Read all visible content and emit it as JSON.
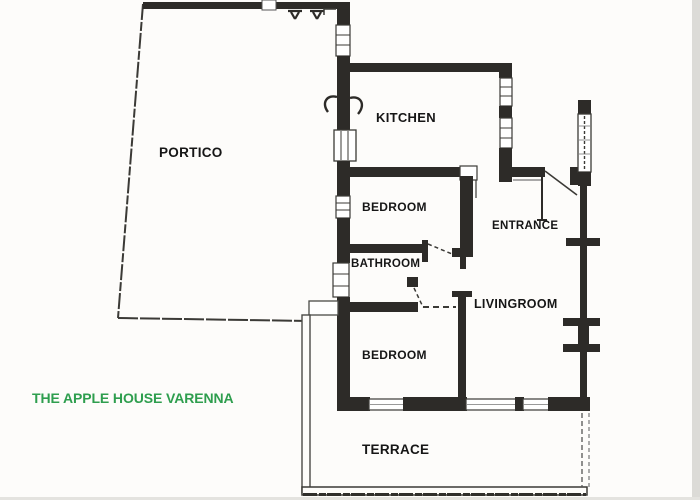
{
  "title": {
    "text": "THE APPLE HOUSE VARENNA",
    "color": "#2e9e4e"
  },
  "rooms": [
    {
      "name": "portico",
      "label": "PORTICO"
    },
    {
      "name": "kitchen",
      "label": "KITCHEN"
    },
    {
      "name": "bedroom-1",
      "label": "BEDROOM"
    },
    {
      "name": "entrance",
      "label": "ENTRANCE"
    },
    {
      "name": "bathroom",
      "label": "BATHROOM"
    },
    {
      "name": "livingroom",
      "label": "LIVINGROOM"
    },
    {
      "name": "bedroom-2",
      "label": "BEDROOM"
    },
    {
      "name": "terrace",
      "label": "TERRACE"
    }
  ],
  "colors": {
    "wall": "#2d2b28",
    "line": "#3b3a36",
    "label_text": "#161616",
    "title_green": "#2e9e4e",
    "scan_edge_gray": "#dcdbd7"
  }
}
